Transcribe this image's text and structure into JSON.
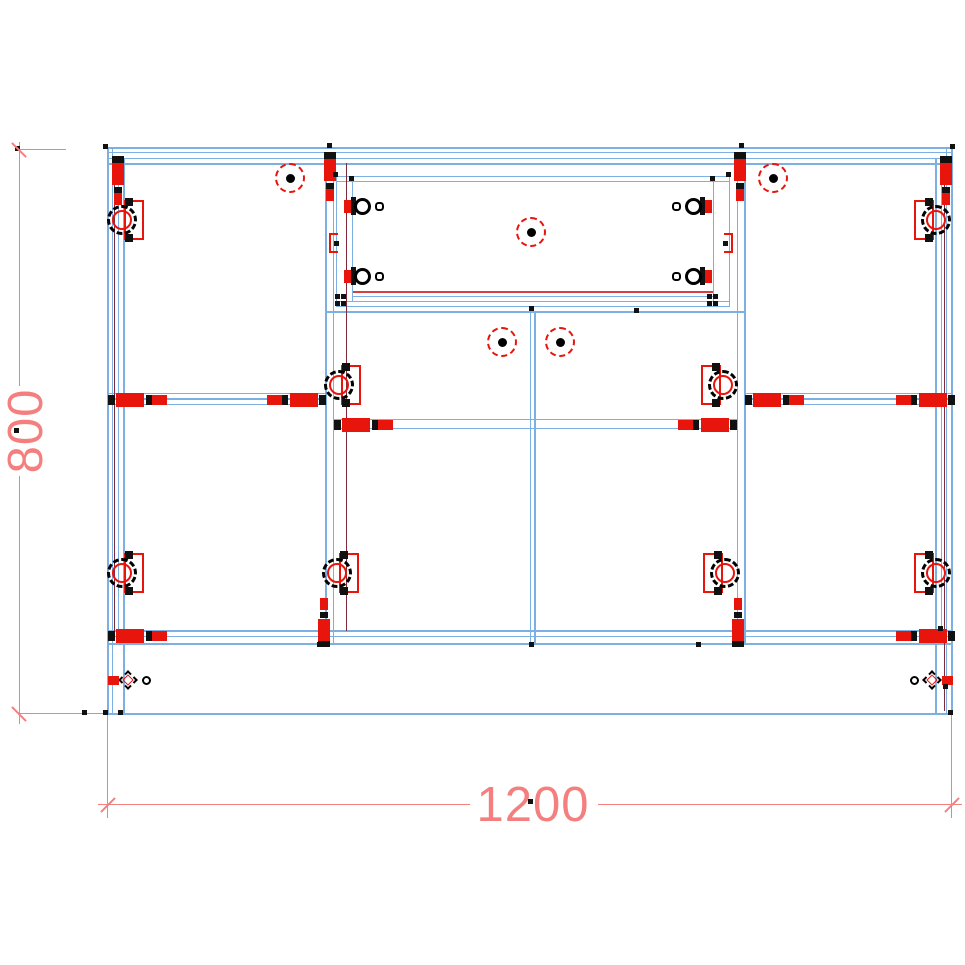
{
  "app": {
    "title": "cabinet-cad-drawing"
  },
  "colors": {
    "blue": "#7CB0E3",
    "maroon": "#7D2B3C",
    "red": "#E8150D",
    "crimson": "#D84040",
    "dim": "#F47F7F",
    "black": "#111111"
  },
  "dim_labels": {
    "width": "1200",
    "height": "800"
  },
  "geometry": {
    "rects": [
      [
        108,
        147,
        845,
        2,
        "blue"
      ],
      [
        108,
        152,
        845,
        1,
        "blue"
      ],
      [
        108,
        158,
        845,
        1,
        "blue"
      ],
      [
        108,
        163,
        845,
        2,
        "blue"
      ],
      [
        108,
        630,
        845,
        2,
        "blue"
      ],
      [
        108,
        636,
        845,
        1,
        "blue"
      ],
      [
        108,
        643,
        845,
        2,
        "blue"
      ],
      [
        108,
        713,
        845,
        2,
        "blue"
      ],
      [
        108,
        393,
        218,
        1,
        "blue"
      ],
      [
        108,
        398,
        218,
        2,
        "blue"
      ],
      [
        108,
        404,
        218,
        1,
        "blue"
      ],
      [
        745,
        393,
        208,
        1,
        "blue"
      ],
      [
        745,
        398,
        208,
        2,
        "blue"
      ],
      [
        745,
        404,
        208,
        1,
        "blue"
      ],
      [
        326,
        311,
        419,
        2,
        "blue"
      ],
      [
        334,
        419,
        403,
        1,
        "blue"
      ],
      [
        334,
        428,
        403,
        1,
        "blue"
      ],
      [
        336,
        176,
        394,
        1,
        "blue"
      ],
      [
        336,
        181,
        394,
        1,
        "blue"
      ],
      [
        352,
        291,
        362,
        2,
        "crimson"
      ],
      [
        352,
        296,
        362,
        1,
        "blue"
      ],
      [
        336,
        301,
        394,
        1,
        "blue"
      ],
      [
        336,
        306,
        394,
        1,
        "blue"
      ],
      [
        107,
        147,
        2,
        568,
        "blue"
      ],
      [
        112,
        147,
        1,
        568,
        "blue"
      ],
      [
        118,
        158,
        1,
        487,
        "blue"
      ],
      [
        123,
        158,
        2,
        556,
        "blue"
      ],
      [
        951,
        147,
        2,
        568,
        "blue"
      ],
      [
        946,
        147,
        1,
        568,
        "blue"
      ],
      [
        941,
        158,
        1,
        487,
        "blue"
      ],
      [
        935,
        158,
        2,
        556,
        "blue"
      ],
      [
        325,
        152,
        2,
        493,
        "blue"
      ],
      [
        333,
        152,
        1,
        493,
        "blue"
      ],
      [
        737,
        152,
        1,
        493,
        "blue"
      ],
      [
        744,
        152,
        2,
        493,
        "blue"
      ],
      [
        530,
        311,
        1,
        334,
        "blue"
      ],
      [
        534,
        311,
        2,
        334,
        "blue"
      ],
      [
        336,
        176,
        1,
        131,
        "blue"
      ],
      [
        352,
        181,
        1,
        120,
        "blue"
      ],
      [
        713,
        181,
        1,
        120,
        "blue"
      ],
      [
        729,
        176,
        1,
        131,
        "blue"
      ],
      [
        114,
        163,
        1,
        468,
        "maroon"
      ],
      [
        346,
        163,
        1,
        468,
        "maroon"
      ],
      [
        944,
        163,
        1,
        548,
        "maroon"
      ],
      [
        19,
        142,
        1,
        244,
        "dim"
      ],
      [
        19,
        476,
        1,
        248,
        "dim"
      ],
      [
        19,
        149,
        47,
        1,
        "dim"
      ],
      [
        19,
        713,
        90,
        1,
        "dim"
      ],
      [
        98,
        804,
        372,
        1,
        "dim"
      ],
      [
        598,
        804,
        364,
        1,
        "dim"
      ],
      [
        107,
        714,
        1,
        104,
        "dim"
      ],
      [
        951,
        714,
        1,
        104,
        "dim"
      ]
    ],
    "vcams": [
      {
        "x": 112,
        "y": 156,
        "flip": false
      },
      {
        "x": 324,
        "y": 152,
        "flip": false
      },
      {
        "x": 734,
        "y": 152,
        "flip": false
      },
      {
        "x": 940,
        "y": 156,
        "flip": false
      },
      {
        "x": 318,
        "y": 598,
        "flip": true
      },
      {
        "x": 732,
        "y": 598,
        "flip": true
      }
    ],
    "hcams": [
      {
        "x": 108,
        "y": 393,
        "dir": "r"
      },
      {
        "x": 326,
        "y": 393,
        "dir": "l"
      },
      {
        "x": 745,
        "y": 393,
        "dir": "r"
      },
      {
        "x": 955,
        "y": 393,
        "dir": "l"
      },
      {
        "x": 334,
        "y": 418,
        "dir": "r"
      },
      {
        "x": 737,
        "y": 418,
        "dir": "l"
      },
      {
        "x": 108,
        "y": 629,
        "dir": "r"
      },
      {
        "x": 955,
        "y": 629,
        "dir": "l"
      }
    ],
    "hinges": [
      {
        "x": 122,
        "y": 220,
        "side": "r"
      },
      {
        "x": 122,
        "y": 573,
        "side": "r"
      },
      {
        "x": 339,
        "y": 385,
        "side": "r"
      },
      {
        "x": 337,
        "y": 573,
        "side": "r"
      },
      {
        "x": 723,
        "y": 385,
        "side": "l"
      },
      {
        "x": 725,
        "y": 573,
        "side": "l"
      },
      {
        "x": 936,
        "y": 220,
        "side": "l"
      },
      {
        "x": 936,
        "y": 573,
        "side": "l"
      }
    ],
    "knobs": [
      {
        "x": 290,
        "y": 178
      },
      {
        "x": 773,
        "y": 178
      },
      {
        "x": 531,
        "y": 232
      },
      {
        "x": 502,
        "y": 342
      },
      {
        "x": 560,
        "y": 342
      }
    ],
    "slides": [
      {
        "x": 358,
        "y": 206,
        "dir": "r"
      },
      {
        "x": 358,
        "y": 276,
        "dir": "r"
      },
      {
        "x": 698,
        "y": 206,
        "dir": "l"
      },
      {
        "x": 698,
        "y": 276,
        "dir": "l"
      }
    ],
    "brackets": [
      {
        "x": 329,
        "y": 233,
        "open": "r"
      },
      {
        "x": 724,
        "y": 233,
        "open": "l"
      }
    ],
    "legs": [
      {
        "x": 128,
        "y": 680,
        "circle": "r"
      },
      {
        "x": 932,
        "y": 680,
        "circle": "l"
      }
    ],
    "dots": [
      [
        17,
        148
      ],
      [
        105,
        146
      ],
      [
        329,
        145
      ],
      [
        741,
        145
      ],
      [
        952,
        146
      ],
      [
        531,
        308
      ],
      [
        636,
        310
      ],
      [
        319,
        644
      ],
      [
        531,
        644
      ],
      [
        698,
        644
      ],
      [
        84,
        712
      ],
      [
        105,
        712
      ],
      [
        120,
        712
      ],
      [
        950,
        712
      ],
      [
        945,
        686
      ],
      [
        940,
        628
      ],
      [
        530,
        801
      ],
      [
        16,
        430
      ],
      [
        335,
        174
      ],
      [
        351,
        178
      ],
      [
        712,
        178
      ],
      [
        728,
        174
      ],
      [
        337,
        296
      ],
      [
        343,
        296
      ],
      [
        337,
        303
      ],
      [
        343,
        303
      ],
      [
        709,
        296
      ],
      [
        715,
        296
      ],
      [
        709,
        303
      ],
      [
        715,
        303
      ]
    ],
    "ticks": [
      {
        "x": 19,
        "y": 150,
        "a": 45
      },
      {
        "x": 19,
        "y": 714,
        "a": 45
      },
      {
        "x": 108,
        "y": 805,
        "a": -45
      },
      {
        "x": 952,
        "y": 805,
        "a": -45
      }
    ]
  }
}
